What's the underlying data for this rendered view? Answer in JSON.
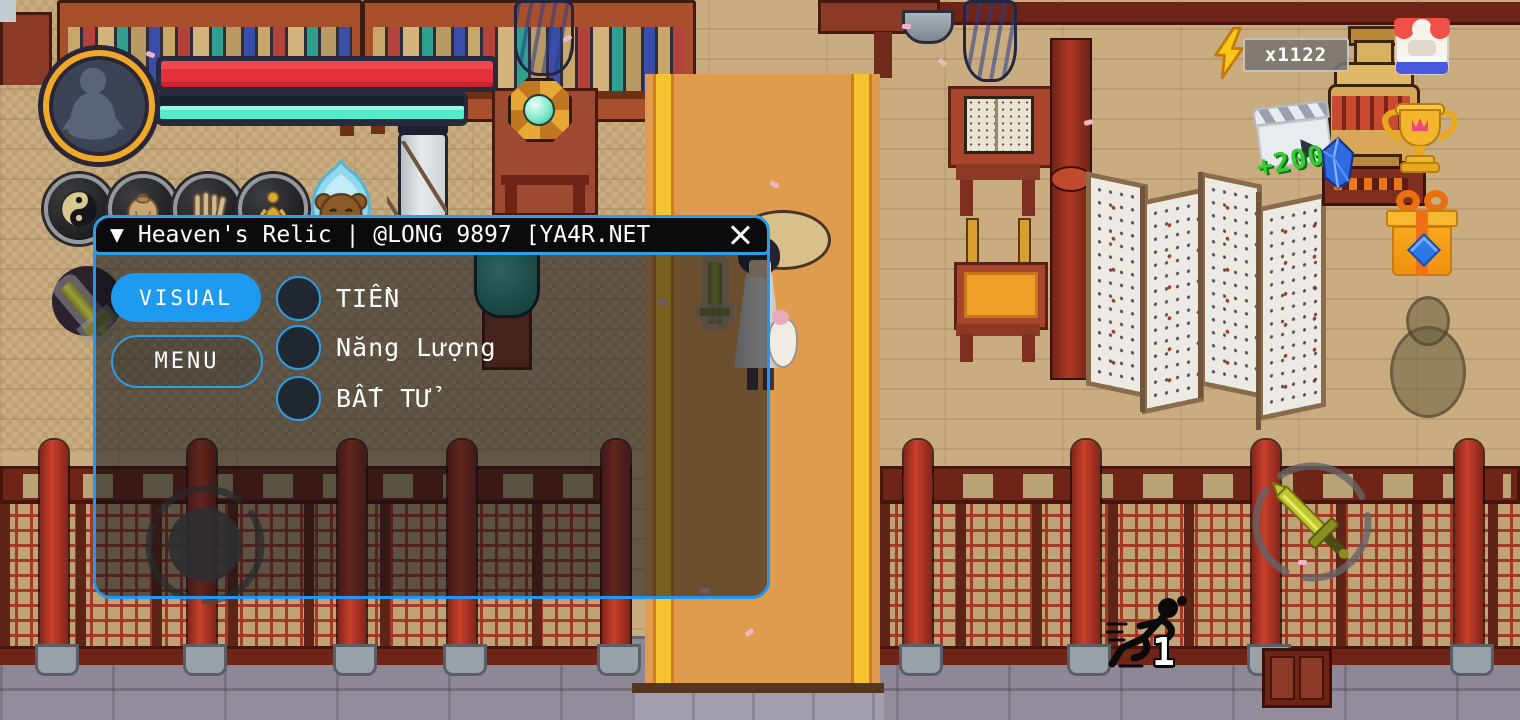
{
  "menu": {
    "collapse_icon": "▼",
    "title": "Heaven's Relic | @LONG 9897 [YA4R.NET",
    "accent_color": "#2196f3",
    "tabs": [
      {
        "label": "VISUAL",
        "active": true
      },
      {
        "label": "MENU",
        "active": false
      }
    ],
    "options": [
      {
        "label": "TIỀN",
        "checked": false
      },
      {
        "label": "Năng Lượng",
        "checked": false
      },
      {
        "label": "BẤT TỬ",
        "checked": false
      }
    ]
  },
  "hud": {
    "player": {
      "avatar_icon": "meditating-figure-icon",
      "hp_color": "#e5303c",
      "hp_percent": 100,
      "mp_color": "#55eac9",
      "mp_percent": 100
    },
    "skills": [
      {
        "icon": "yin-yang-icon"
      },
      {
        "icon": "pouch-icon"
      },
      {
        "icon": "scrolls-icon"
      },
      {
        "icon": "golden-statue-icon"
      },
      {
        "icon": "spirit-bear-icon"
      }
    ],
    "energy": {
      "icon": "lightning-icon",
      "count": "x1122"
    },
    "shop": {
      "icon": "shop-icon"
    },
    "trophy": {
      "icon": "trophy-icon"
    },
    "ad_reward": {
      "icon": "video-clapper-icon",
      "amount": "+200",
      "gem_icon": "blue-crystal-icon"
    },
    "gift": {
      "icon": "gift-box-icon"
    },
    "attack": {
      "icon": "sword-icon"
    },
    "dash": {
      "icon": "runner-icon",
      "count": "1"
    }
  }
}
